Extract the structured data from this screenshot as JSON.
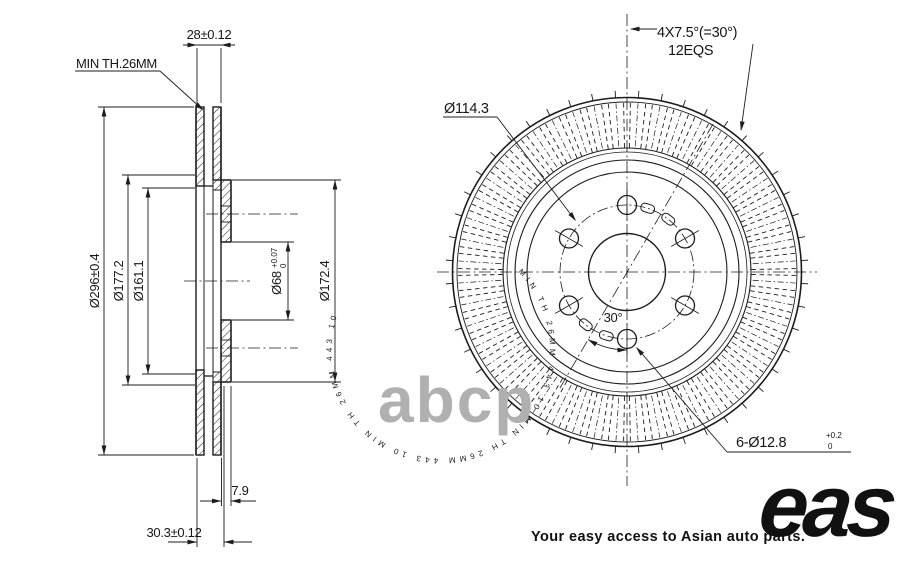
{
  "drawing": {
    "type": "brake-disc engineering drawing",
    "section_view": {
      "dim_plate_pair_width": "28±0.12",
      "min_thickness_note": "MIN TH.26MM",
      "dia_outer": "Ø296±0.4",
      "dia_177": "Ø177.2",
      "dia_161": "Ø161.1",
      "dia_bore": "Ø68",
      "dia_bore_tol_up": "+0.07",
      "dia_bore_tol_dn": "0",
      "dia_hub": "Ø172.4",
      "dim_hub_offset": "7.9",
      "dim_total_width": "30.3±0.12"
    },
    "front_view": {
      "dia_pcd": "Ø114.3",
      "vane_note_line1": "4X7.5°(=30°)",
      "vane_note_line2": "12EQS",
      "angle_note": "30°",
      "bolt_note": "6-Ø12.8",
      "bolt_tol_up": "+0.2",
      "bolt_tol_dn": "0",
      "stamp_text": "MIN TH 26MM",
      "stamp_numbers": "443 10"
    }
  },
  "watermark": "abcp",
  "brand": {
    "logo": "eas",
    "tagline": "Your easy access to Asian auto parts."
  }
}
